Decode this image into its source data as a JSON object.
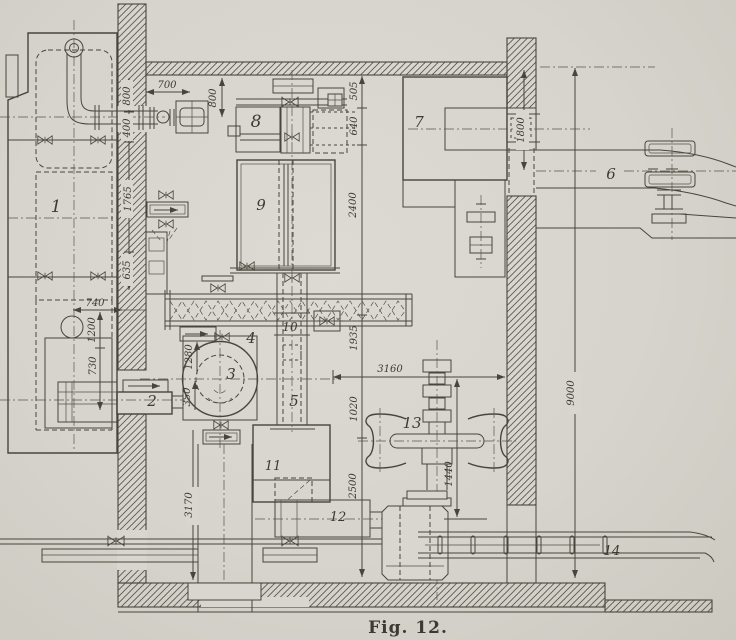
{
  "figure": {
    "caption": "Fig. 12."
  },
  "parts": {
    "n1": "1",
    "n2": "2",
    "n3": "3",
    "n4": "4",
    "n5": "5",
    "n6": "6",
    "n7": "7",
    "n8": "8",
    "n9": "9",
    "n10": "10",
    "n11": "11",
    "n12": "12",
    "n13": "13",
    "n14": "14"
  },
  "dims": {
    "d700": "700",
    "d800_top": "800",
    "d800_wall": "800",
    "d400": "400",
    "d1765": "1765",
    "d635": "635",
    "d740": "740",
    "d1200": "1200",
    "d730": "730",
    "d1280": "1280",
    "d350": "350",
    "d3170": "3170",
    "d505": "505",
    "d640": "640",
    "d2400": "2400",
    "d1935": "1935",
    "d3160": "3160",
    "d1020": "1020",
    "d2500": "2500",
    "d1440": "1440",
    "d1800": "1800",
    "d9000": "9000"
  },
  "colors": {
    "paper": "#d8d6ce",
    "ink": "#49453c"
  }
}
